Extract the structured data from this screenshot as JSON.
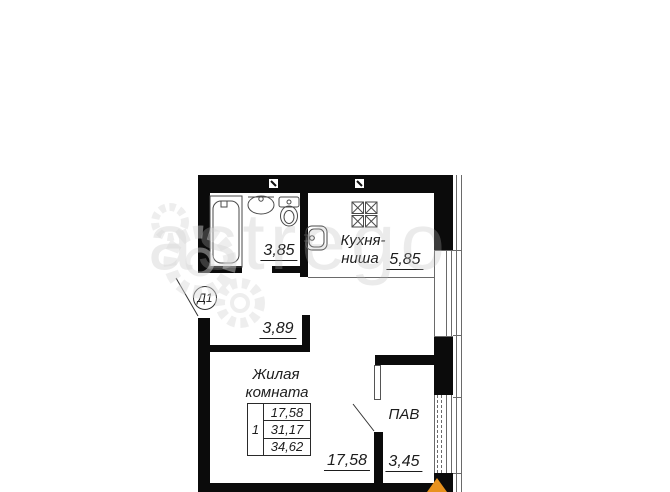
{
  "plan": {
    "door": {
      "label": "Д1"
    },
    "bathroom": {
      "area": "3,85"
    },
    "kitchen": {
      "name_line1": "Кухня-",
      "name_line2": "ниша",
      "area": "5,85"
    },
    "hallway": {
      "area": "3,89"
    },
    "living": {
      "name_line1": "Жилая",
      "name_line2": "комната",
      "area": "17,58"
    },
    "pantry": {
      "name": "ПАВ",
      "area": "3,45"
    },
    "area_table": {
      "rooms_count": "1",
      "rows": [
        "17,58",
        "31,17",
        "34,62"
      ]
    }
  },
  "watermark": {
    "text": "astrego"
  },
  "colors": {
    "wall": "#0b0b0b",
    "compass_north": "#E8921E",
    "line": "#6a6a6a"
  }
}
